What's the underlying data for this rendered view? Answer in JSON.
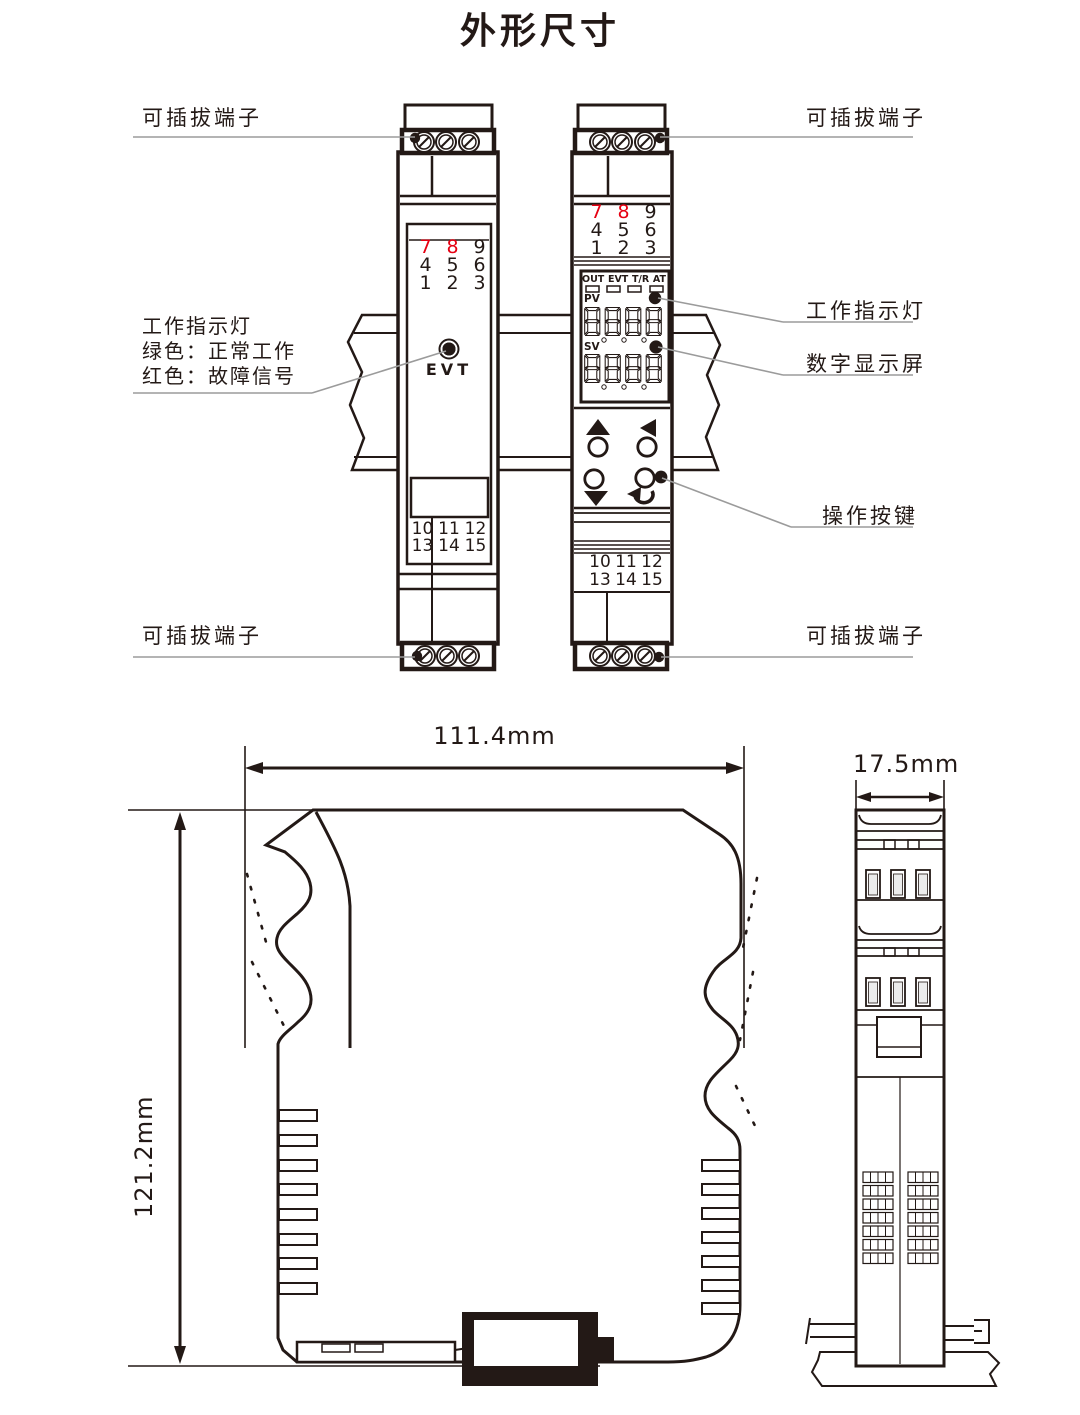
{
  "title": "外形尺寸",
  "palette": {
    "line": "#231916",
    "red": "#e60012",
    "leader": "#9b9b9b",
    "bg": "#ffffff"
  },
  "callouts": {
    "top_left": "可插拔端子",
    "top_right": "可插拔端子",
    "bottom_left": "可插拔端子",
    "bottom_right": "可插拔端子",
    "indicator_left": {
      "line1": "工作指示灯",
      "line2": "绿色：正常工作",
      "line3": "红色：故障信号"
    },
    "indicator_right": "工作指示灯",
    "display": "数字显示屏",
    "buttons": "操作按键"
  },
  "left_module": {
    "led_label": "EVT",
    "top_terminals": {
      "r1": [
        "7",
        "8",
        "9"
      ],
      "r2": [
        "4",
        "5",
        "6"
      ],
      "r3": [
        "1",
        "2",
        "3"
      ]
    },
    "bottom_terminals": {
      "r1": [
        "10",
        "11",
        "12"
      ],
      "r2": [
        "13",
        "14",
        "15"
      ]
    }
  },
  "right_module": {
    "top_terminals": {
      "r1": [
        "7",
        "8",
        "9"
      ],
      "r2": [
        "4",
        "5",
        "6"
      ],
      "r3": [
        "1",
        "2",
        "3"
      ]
    },
    "status_labels": [
      "OUT",
      "EVT",
      "T/R",
      "AT"
    ],
    "pv_label": "PV",
    "sv_label": "SV",
    "pv_value": "8888",
    "sv_value": "8888",
    "bottom_terminals": {
      "r1": [
        "10",
        "11",
        "12"
      ],
      "r2": [
        "13",
        "14",
        "15"
      ]
    }
  },
  "dimensions": {
    "width": "111.4mm",
    "height": "121.2mm",
    "depth": "17.5mm"
  }
}
